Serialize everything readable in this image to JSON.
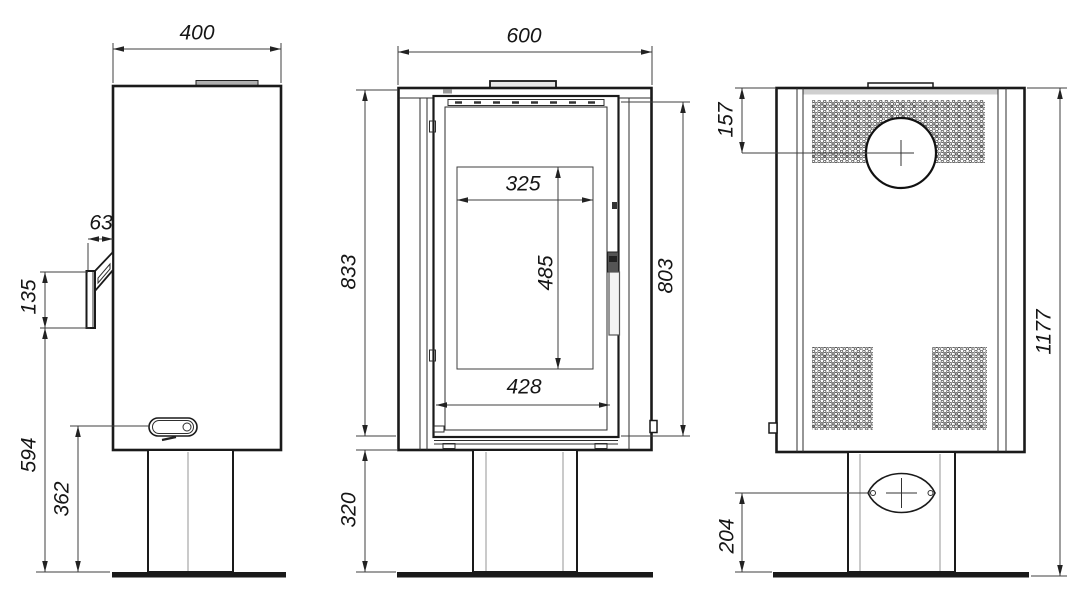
{
  "colors": {
    "line": "#1a1a1a",
    "dim_line": "#3f3f3f",
    "light_line": "#a6a6a6",
    "collar_fill": "#b0b0b0",
    "background": "#ffffff"
  },
  "views": {
    "side": {
      "dims": {
        "top_width": "400",
        "handle_offset": "63",
        "handle_height": "135",
        "handle_bottom_from_floor": "594",
        "lever_from_floor": "362"
      }
    },
    "front": {
      "dims": {
        "top_width": "600",
        "body_height": "833",
        "glass_width": "325",
        "glass_height": "485",
        "door_width": "428",
        "door_height": "803",
        "pedestal_height": "320"
      }
    },
    "rear": {
      "dims": {
        "flue_center_from_top": "157",
        "total_height": "1177",
        "inlet_center_from_floor": "204"
      }
    }
  }
}
